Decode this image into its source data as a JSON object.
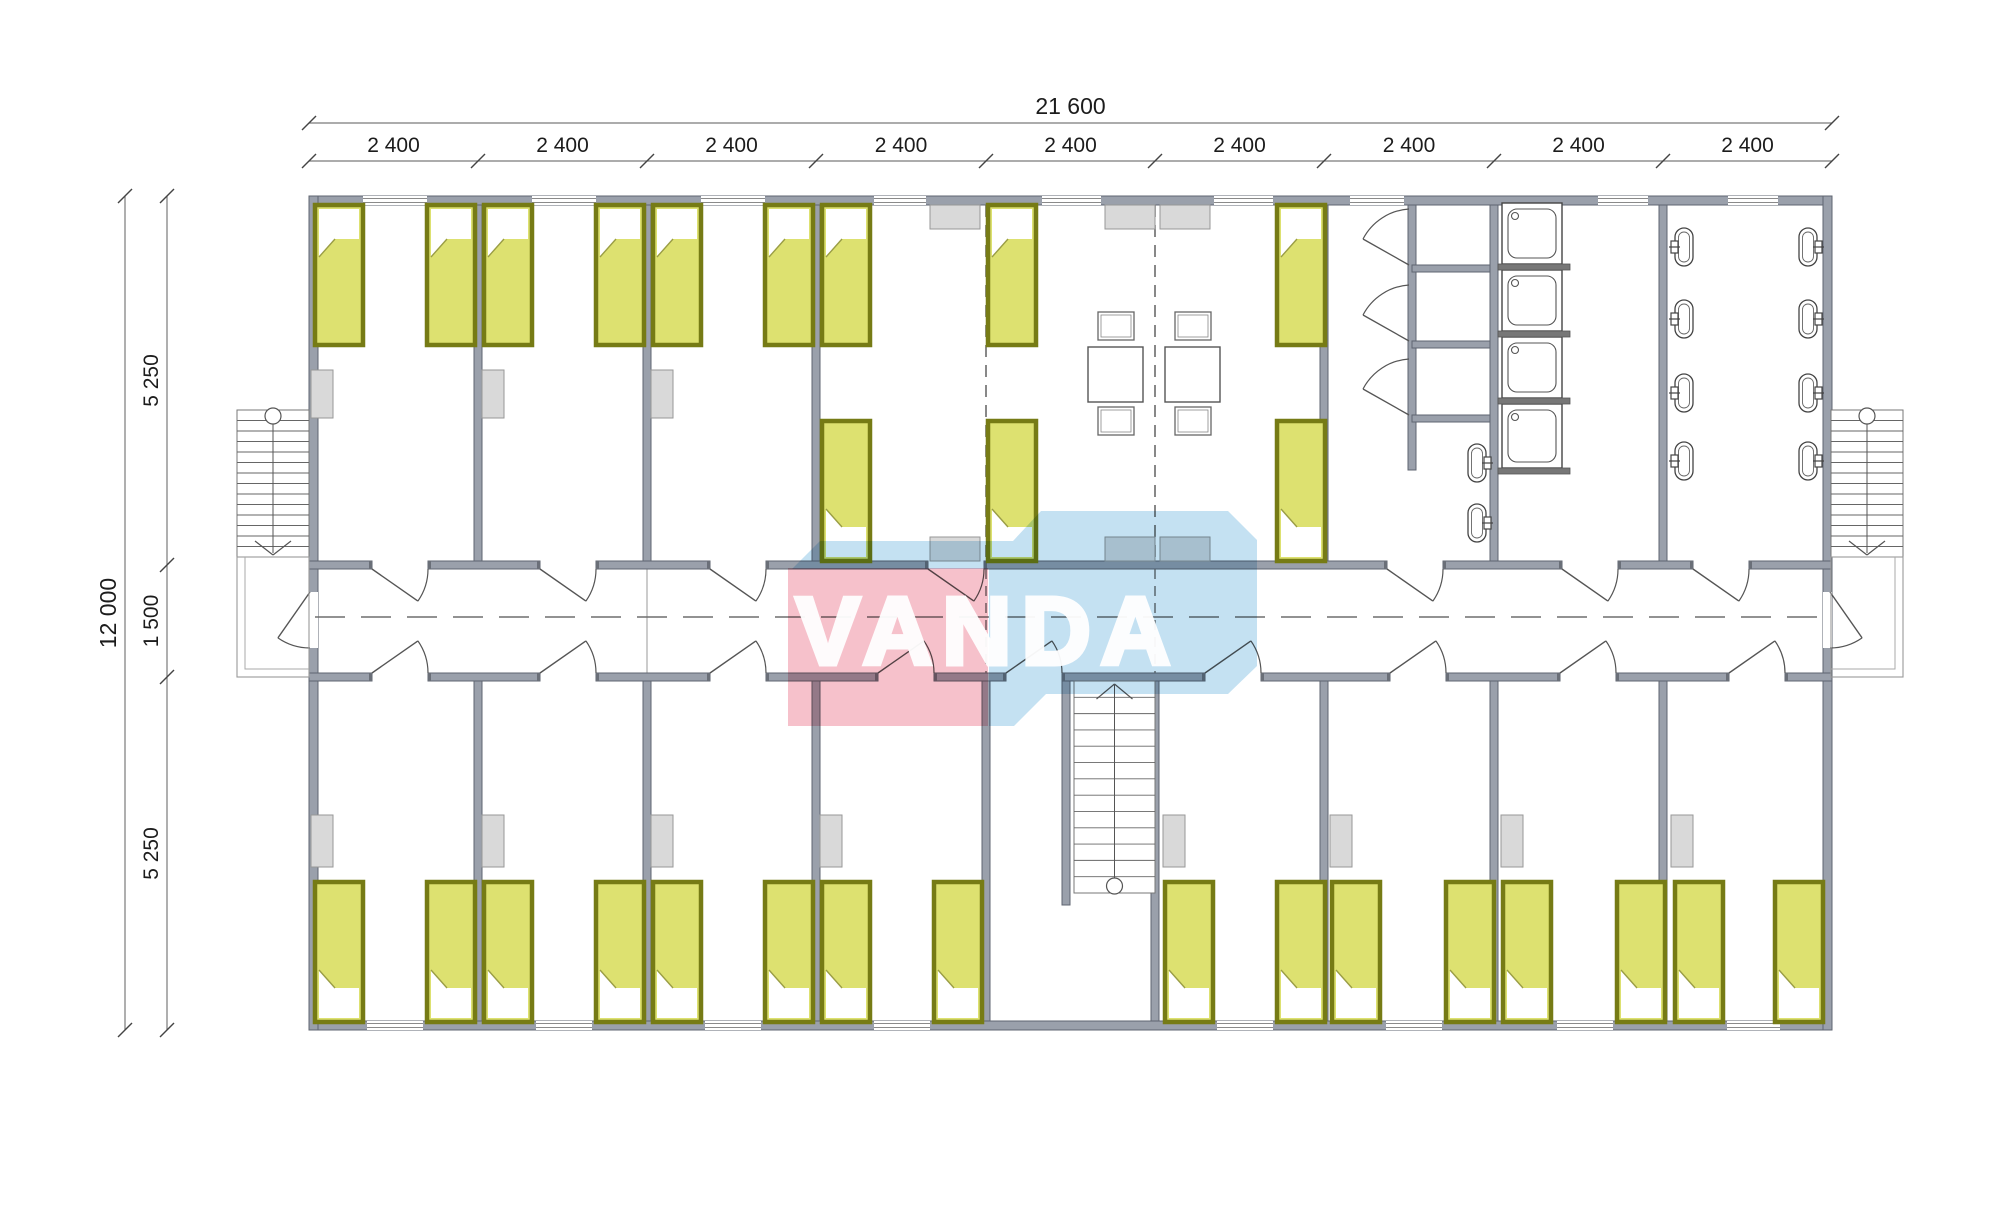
{
  "title": "dormitory-floor-plan",
  "watermark": {
    "text": "VANDA",
    "pink": "#f5b6c2",
    "blue": "#badcf0",
    "text_color": "#ffffff"
  },
  "dimensions": {
    "total_width": "21 600",
    "width_segments": [
      "2 400",
      "2 400",
      "2 400",
      "2 400",
      "2 400",
      "2 400",
      "2 400",
      "2 400",
      "2 400"
    ],
    "total_height": "12 000",
    "height_segments": [
      "5 250",
      "1 500",
      "5 250"
    ]
  },
  "colors": {
    "wall_fill": "#9aa0ab",
    "wall_edge": "#5f6570",
    "bed_fill": "#dde170",
    "bed_border": "#767b15",
    "locker_fill": "#d9d9d9",
    "locker_edge": "#979797",
    "fixture_line": "#4a4a4a",
    "dimension_line": "#7a7a7a",
    "dimension_text": "#1c1c1c",
    "dash_line": "#6a6a6a"
  },
  "fixtures": {
    "bed_count": 28,
    "shower_tray_count": 4,
    "shower_cubicle_count": 3,
    "toilet_count": 10,
    "table_count": 2,
    "chair_count": 4,
    "wardrobe_count": 11,
    "stair_names": [
      "left-exterior-stair",
      "central-stair",
      "right-exterior-stair"
    ]
  }
}
